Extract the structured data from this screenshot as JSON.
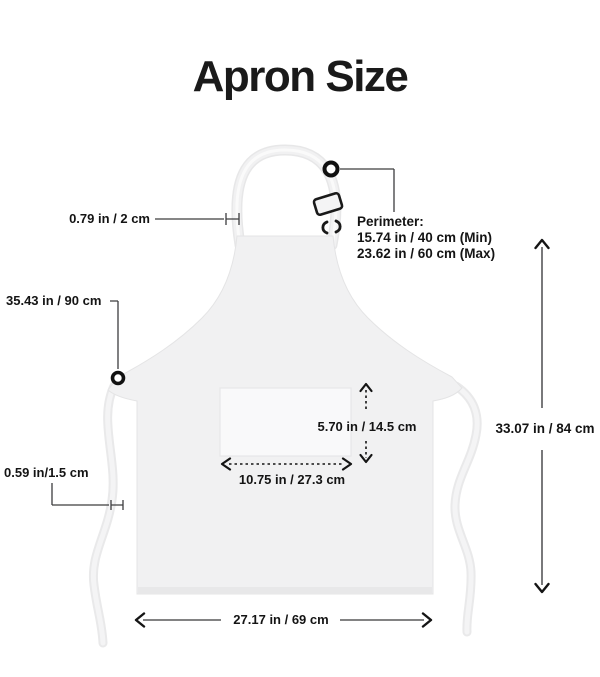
{
  "title": "Apron Size",
  "labels": {
    "neck_strap_width": "0.79 in / 2 cm",
    "perimeter_title": "Perimeter:",
    "perimeter_min": "15.74 in / 40 cm (Min)",
    "perimeter_max": "23.62 in / 60 cm (Max)",
    "waist_tie_length": "35.43 in / 90 cm",
    "waist_tie_width": "0.59 in/1.5 cm",
    "pocket_height": "5.70 in / 14.5 cm",
    "pocket_width": "10.75 in / 27.3 cm",
    "apron_height": "33.07 in / 84 cm",
    "apron_width": "27.17 in / 69 cm"
  },
  "icons": [
    {
      "name": "ring-marker-neck",
      "shape": "circle-outline"
    },
    {
      "name": "ring-marker-waist",
      "shape": "circle-outline"
    },
    {
      "name": "strap-buckle-icon",
      "shape": "rotated-rect-outline"
    },
    {
      "name": "strap-clip-icon",
      "shape": "bracket-pair"
    }
  ],
  "colors": {
    "background": "#ffffff",
    "apron_fill": "#f1f1f2",
    "apron_edge": "#e4e4e5",
    "pocket_fill": "#f9f9fa",
    "hem_fill": "#e8e8e9",
    "text": "#141414",
    "leader_line": "#3d3d3f",
    "arrow_head": "#151515"
  }
}
